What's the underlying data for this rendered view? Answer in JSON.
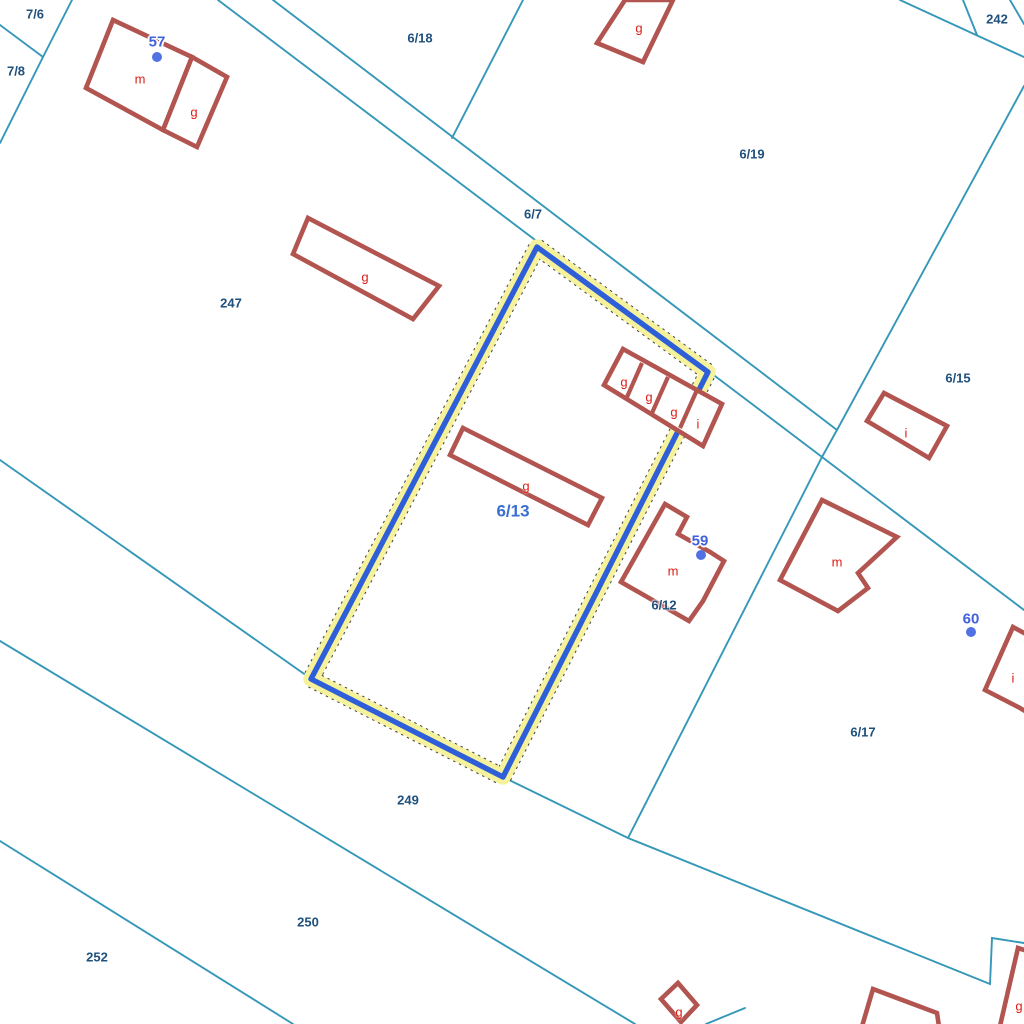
{
  "map": {
    "type": "cadastral-parcel-map",
    "selected_parcel_id": "6/13",
    "colors": {
      "boundary": "#3598b8",
      "building": "#b25450",
      "building_label": "#dd1d16",
      "parcel_label": "#20517e",
      "selected_label": "#3a6fd0",
      "house_number": "#4161dd",
      "house_dot": "#5272e3",
      "highlight_stroke": "#2e5fd9",
      "highlight_halo": "#f5f29b"
    },
    "labels": [
      {
        "type": "parcel",
        "text": "7/6",
        "x": 35,
        "y": 14
      },
      {
        "type": "parcel",
        "text": "7/8",
        "x": 16,
        "y": 71
      },
      {
        "type": "parcel",
        "text": "6/18",
        "x": 420,
        "y": 38
      },
      {
        "type": "parcel",
        "text": "6/7",
        "x": 533,
        "y": 214
      },
      {
        "type": "parcel",
        "text": "6/19",
        "x": 752,
        "y": 154
      },
      {
        "type": "parcel",
        "text": "242",
        "x": 997,
        "y": 19
      },
      {
        "type": "parcel",
        "text": "247",
        "x": 231,
        "y": 303
      },
      {
        "type": "parcel",
        "text": "6/15",
        "x": 958,
        "y": 378
      },
      {
        "type": "parcel-selected",
        "text": "6/13",
        "x": 513,
        "y": 511
      },
      {
        "type": "parcel",
        "text": "6/12",
        "x": 664,
        "y": 605
      },
      {
        "type": "parcel",
        "text": "6/17",
        "x": 863,
        "y": 732
      },
      {
        "type": "parcel",
        "text": "249",
        "x": 408,
        "y": 800
      },
      {
        "type": "parcel",
        "text": "250",
        "x": 308,
        "y": 922
      },
      {
        "type": "parcel",
        "text": "252",
        "x": 97,
        "y": 957
      },
      {
        "type": "building",
        "text": "m",
        "x": 140,
        "y": 79
      },
      {
        "type": "building",
        "text": "g",
        "x": 194,
        "y": 112
      },
      {
        "type": "building",
        "text": "g",
        "x": 365,
        "y": 277
      },
      {
        "type": "building",
        "text": "g",
        "x": 639,
        "y": 28
      },
      {
        "type": "building",
        "text": "g",
        "x": 624,
        "y": 382
      },
      {
        "type": "building",
        "text": "g",
        "x": 649,
        "y": 397
      },
      {
        "type": "building",
        "text": "g",
        "x": 674,
        "y": 412
      },
      {
        "type": "building",
        "text": "i",
        "x": 698,
        "y": 424
      },
      {
        "type": "building",
        "text": "g",
        "x": 526,
        "y": 486
      },
      {
        "type": "building",
        "text": "m",
        "x": 673,
        "y": 571
      },
      {
        "type": "building",
        "text": "m",
        "x": 837,
        "y": 562
      },
      {
        "type": "building",
        "text": "i",
        "x": 906,
        "y": 433
      },
      {
        "type": "building",
        "text": "i",
        "x": 1013,
        "y": 678
      },
      {
        "type": "building",
        "text": "g",
        "x": 679,
        "y": 1012
      },
      {
        "type": "building",
        "text": "g",
        "x": 1019,
        "y": 1006
      },
      {
        "type": "house-number",
        "text": "57",
        "x": 157,
        "y": 42
      },
      {
        "type": "house-number",
        "text": "59",
        "x": 700,
        "y": 541
      },
      {
        "type": "house-number",
        "text": "60",
        "x": 971,
        "y": 619
      }
    ]
  }
}
